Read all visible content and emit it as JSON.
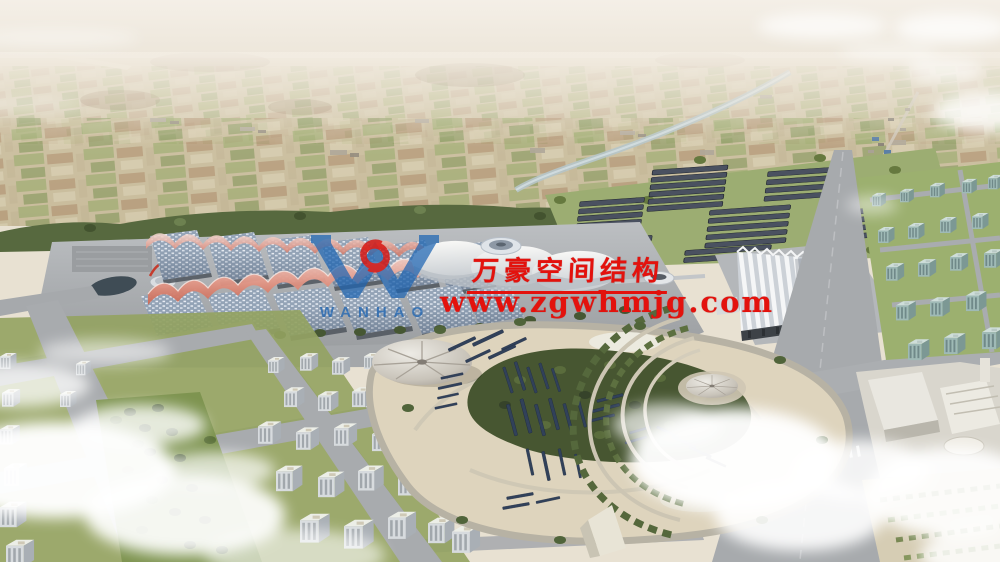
{
  "image": {
    "alt": "Aerial rendering of an exhibition center campus with wave-roofed halls, solar panel arrays, a landscaped park with conical canopies, surrounding city blocks and farmland stretching to a hazy horizon"
  },
  "watermark": {
    "company_name": "万豪空间结构",
    "website": "www.zgwhmjg.com",
    "logo_wordmark": "WANHAO"
  },
  "palette": {
    "watermark_red": "#e3120d",
    "logo_blue": "#1d64b2",
    "logo_emblem_red": "#d8100c",
    "sky_haze": "#f2ece2",
    "farmland_tan": "#cbbf9f",
    "field_green": "#9aa96b",
    "tree_green": "#55683f",
    "hall_roof_blue": "#93a3b6",
    "canopy_pink": "#e49a8a",
    "road_grey": "#a7aaad",
    "park_sand": "#ddd3bc",
    "solar_navy": "#31415a",
    "cloud_white": "#ffffff"
  }
}
